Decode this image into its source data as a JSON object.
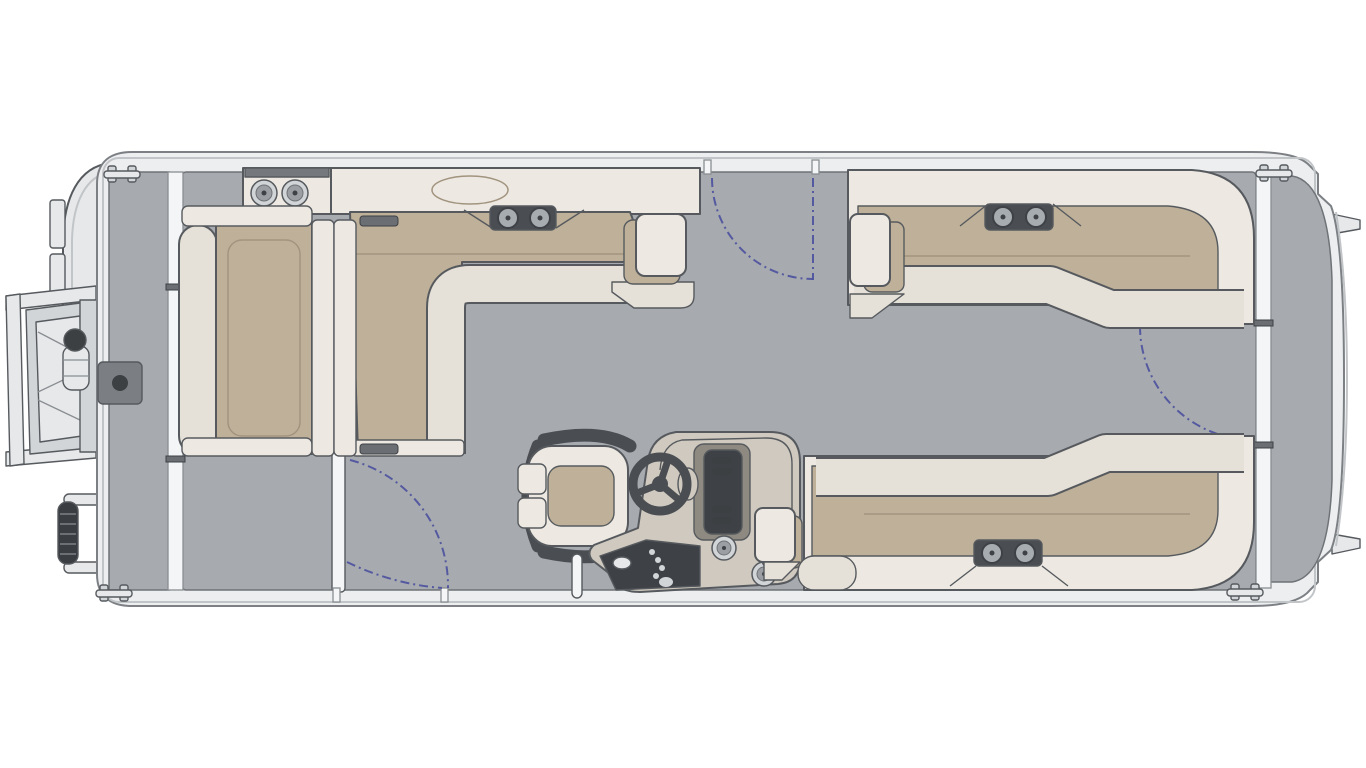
{
  "meta": {
    "diagram_type": "floor-plan",
    "subject": "pontoon-boat",
    "view": "top-down-overhead",
    "orientation": "bow-left-stern-right"
  },
  "colors": {
    "page_bg": "#ffffff",
    "outline": "#565a5e",
    "hull": "#edeef0",
    "hull_edge": "#7c8084",
    "hull_inner": "#c2c5c8",
    "rail": "#f4f5f6",
    "rail_line": "#8a8e92",
    "deck": "#a7abaf",
    "deck_line": "#6f7377",
    "seat_back": "#ede9e2",
    "seat_front": "#e6e1d8",
    "cushion": "#bfb099",
    "stitch": "#a2947f",
    "dark": "#4a4e52",
    "hinge": "#6b6f73",
    "speaker_ring": "#a7acb0",
    "cup_inner": "#9b9fa3",
    "metal_light": "#e7e8ea",
    "metal_mid": "#d2d5d8",
    "console": "#cfc9bf",
    "console_trim": "#8f8a81",
    "panel": "#3e4246",
    "knob": "#3c4043",
    "fender": "#3a3d41",
    "tray": "#75797d",
    "mount": "#7b7f83",
    "arc": "#4b509f"
  },
  "counts": {
    "lounges": 4,
    "captains_chairs": 1,
    "cup_holders": 4,
    "speakers": 6,
    "gates": 4,
    "cleats": 4,
    "motor_mount_tabs": 2
  },
  "components": {
    "bow": [
      "bow-nose",
      "boarding-ladder",
      "ladder-latch",
      "bow-boarding-gate",
      "deck-table-mount",
      "corner-cupholder-console"
    ],
    "lounges": [
      "bow-port-l-lounge",
      "aft-facing-couch",
      "stern-port-l-lounge",
      "stern-starboard-l-lounge"
    ],
    "helm": [
      "captains-chair",
      "steering-wheel",
      "helm-console",
      "instrument-panel",
      "switch-panel",
      "console-cupholders",
      "ski-pylon"
    ],
    "gates": [
      "bow-boarding-gate",
      "port-mid-gate",
      "starboard-side-gate",
      "stern-gate"
    ],
    "hardware": [
      "bow-cleat-port",
      "bow-cleat-starboard",
      "stern-cleat-port",
      "stern-cleat-starboard",
      "side-rails",
      "fender",
      "motor-mount-tabs",
      "stern-platform"
    ]
  }
}
